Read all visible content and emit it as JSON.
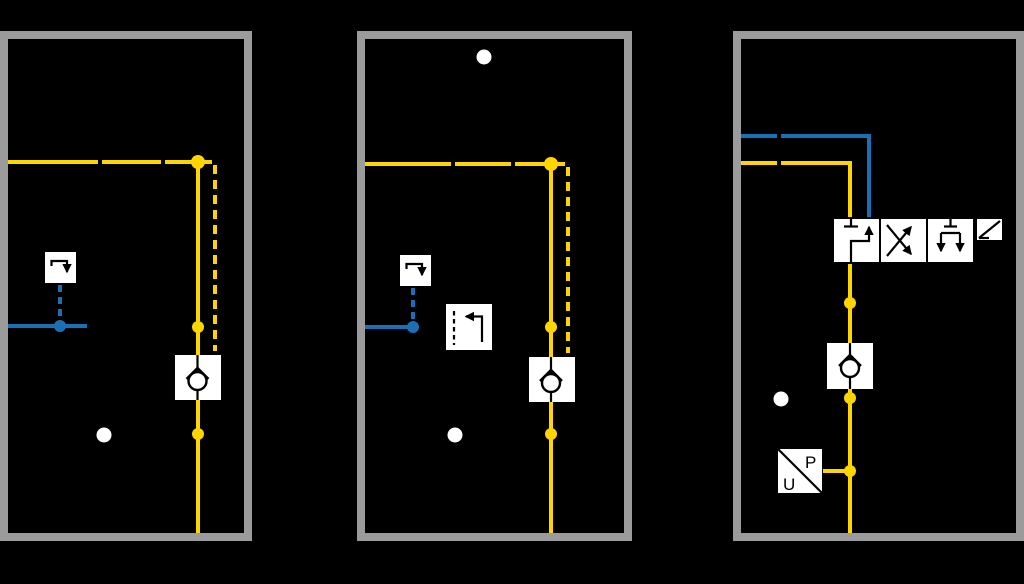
{
  "diagram": {
    "kind": "hydraulic-circuit-comparison",
    "panel_count": 3
  },
  "colors": {
    "bg": "#000000",
    "border": "#9b9b9b",
    "yellow": "#ffd500",
    "blue": "#1b6fb5",
    "white": "#ffffff",
    "black": "#000000"
  },
  "panels": [
    {
      "id": "panel-1",
      "symbols": [
        "pressure-supply-line",
        "pilot-line-dashed",
        "step-command-box",
        "electric-signal-line",
        "check-valve",
        "junction-dot",
        "junction-dot",
        "port-dot"
      ]
    },
    {
      "id": "panel-2",
      "symbols": [
        "port-dot-top",
        "pressure-supply-line",
        "pilot-line-dashed",
        "step-command-box",
        "return-command-box",
        "electric-signal-line",
        "check-valve",
        "junction-dot",
        "junction-dot",
        "port-dot"
      ]
    },
    {
      "id": "panel-3",
      "symbols": [
        "electric-signal-line",
        "pressure-supply-line",
        "directional-control-valve-3-position",
        "lever-actuator",
        "check-valve",
        "pressure-transducer",
        "junction-dot",
        "junction-dot",
        "junction-dot",
        "port-dot"
      ]
    }
  ],
  "transducer": {
    "p_label": "P",
    "u_label": "U"
  }
}
